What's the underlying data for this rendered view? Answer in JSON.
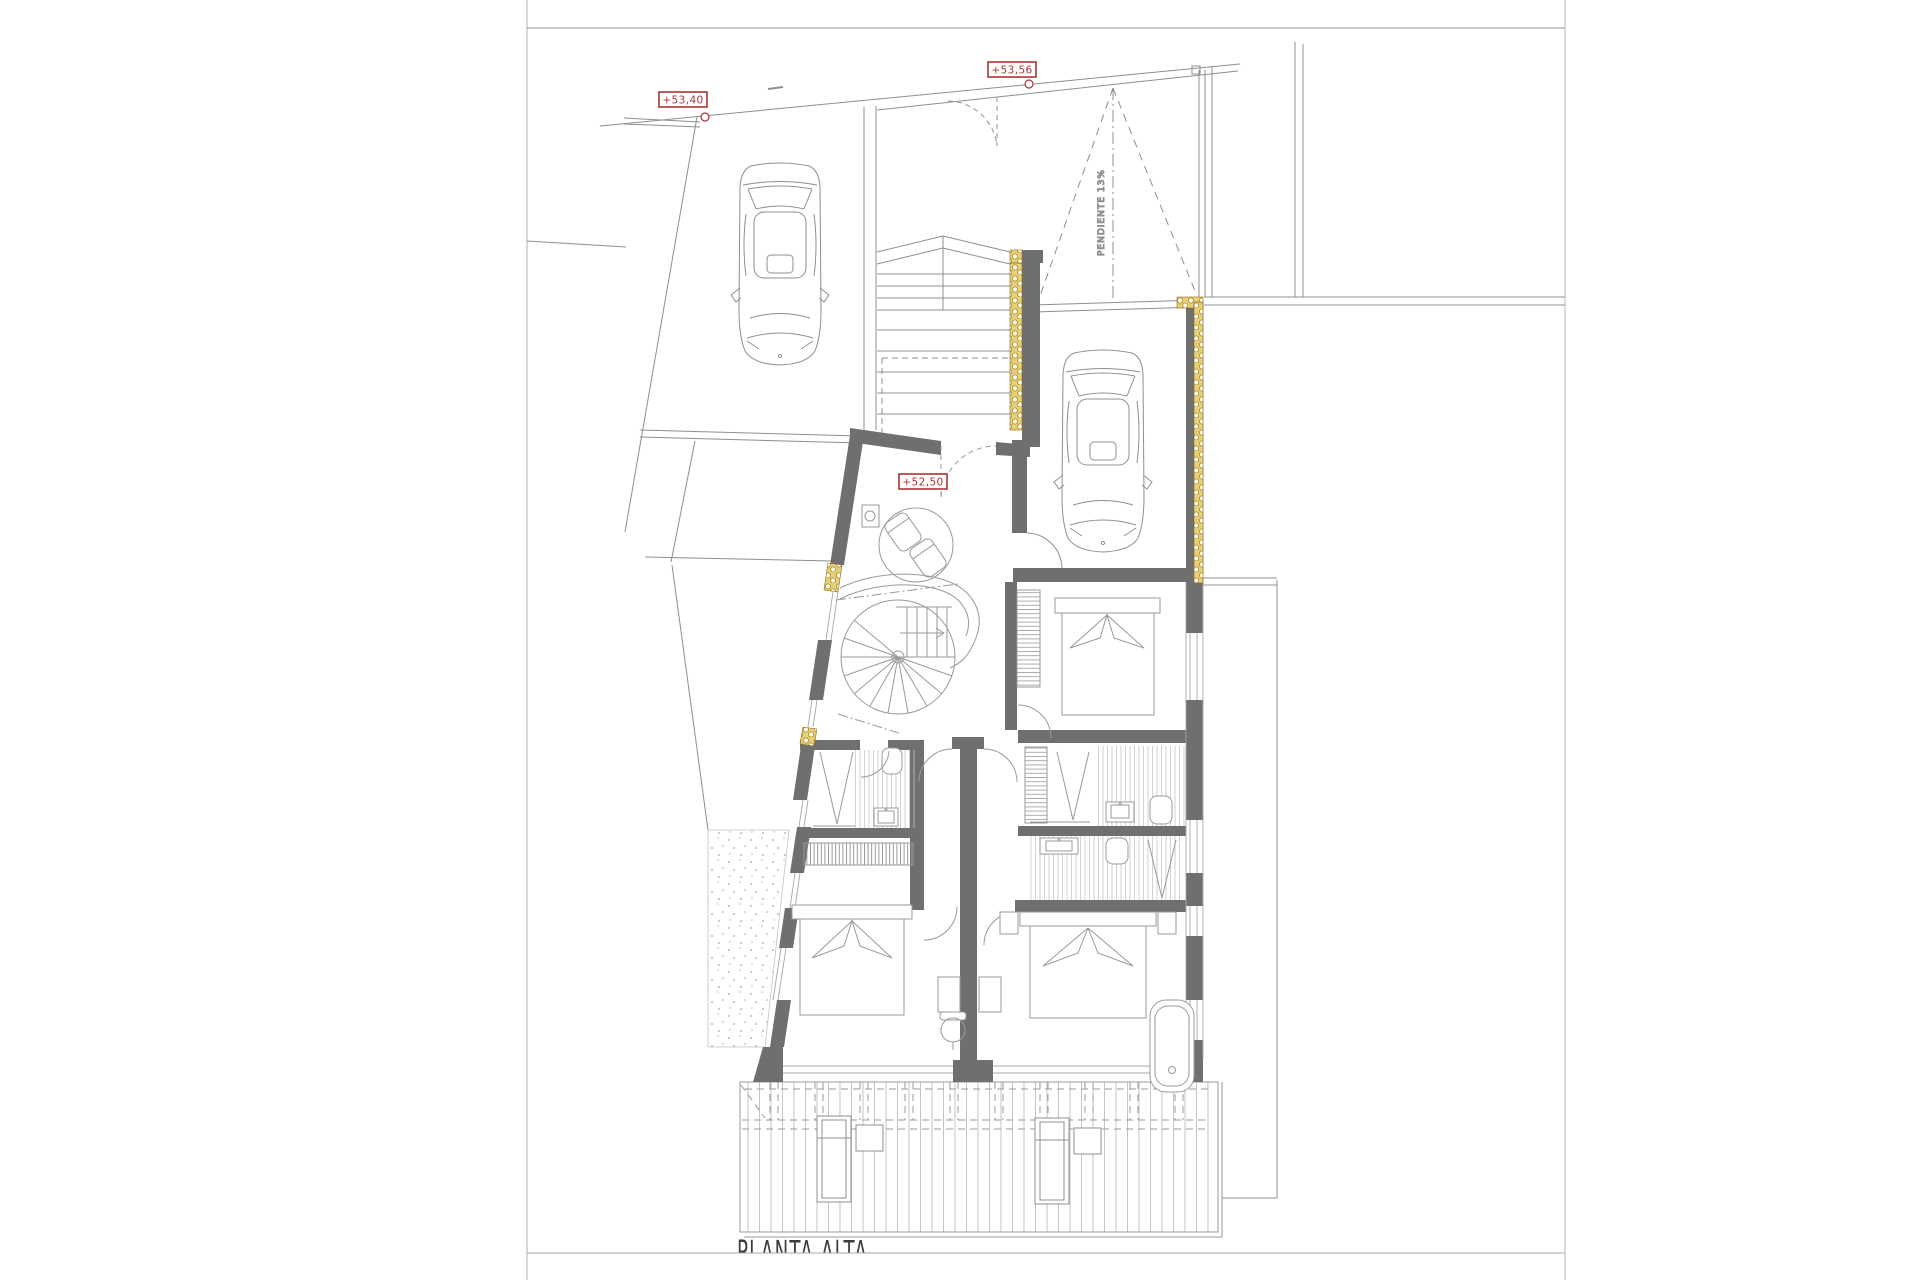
{
  "sheet": {
    "title": "PLANTA ALTA"
  },
  "annotations": {
    "level_a": "+53,40",
    "level_b": "+53,56",
    "level_c": "+52,50",
    "slope": "PENDIENTE 13%"
  },
  "colors": {
    "background": "#ffffff",
    "sheet-border": "#c9c9c9",
    "line": "#8f8f8f",
    "line-light": "#bdbdbd",
    "wall": "#6f6f6f",
    "marker-red": "#ab3535",
    "insulation-fill": "#e8d079",
    "insulation-stroke": "#a8871f",
    "text-dark": "#3d3d3d"
  }
}
